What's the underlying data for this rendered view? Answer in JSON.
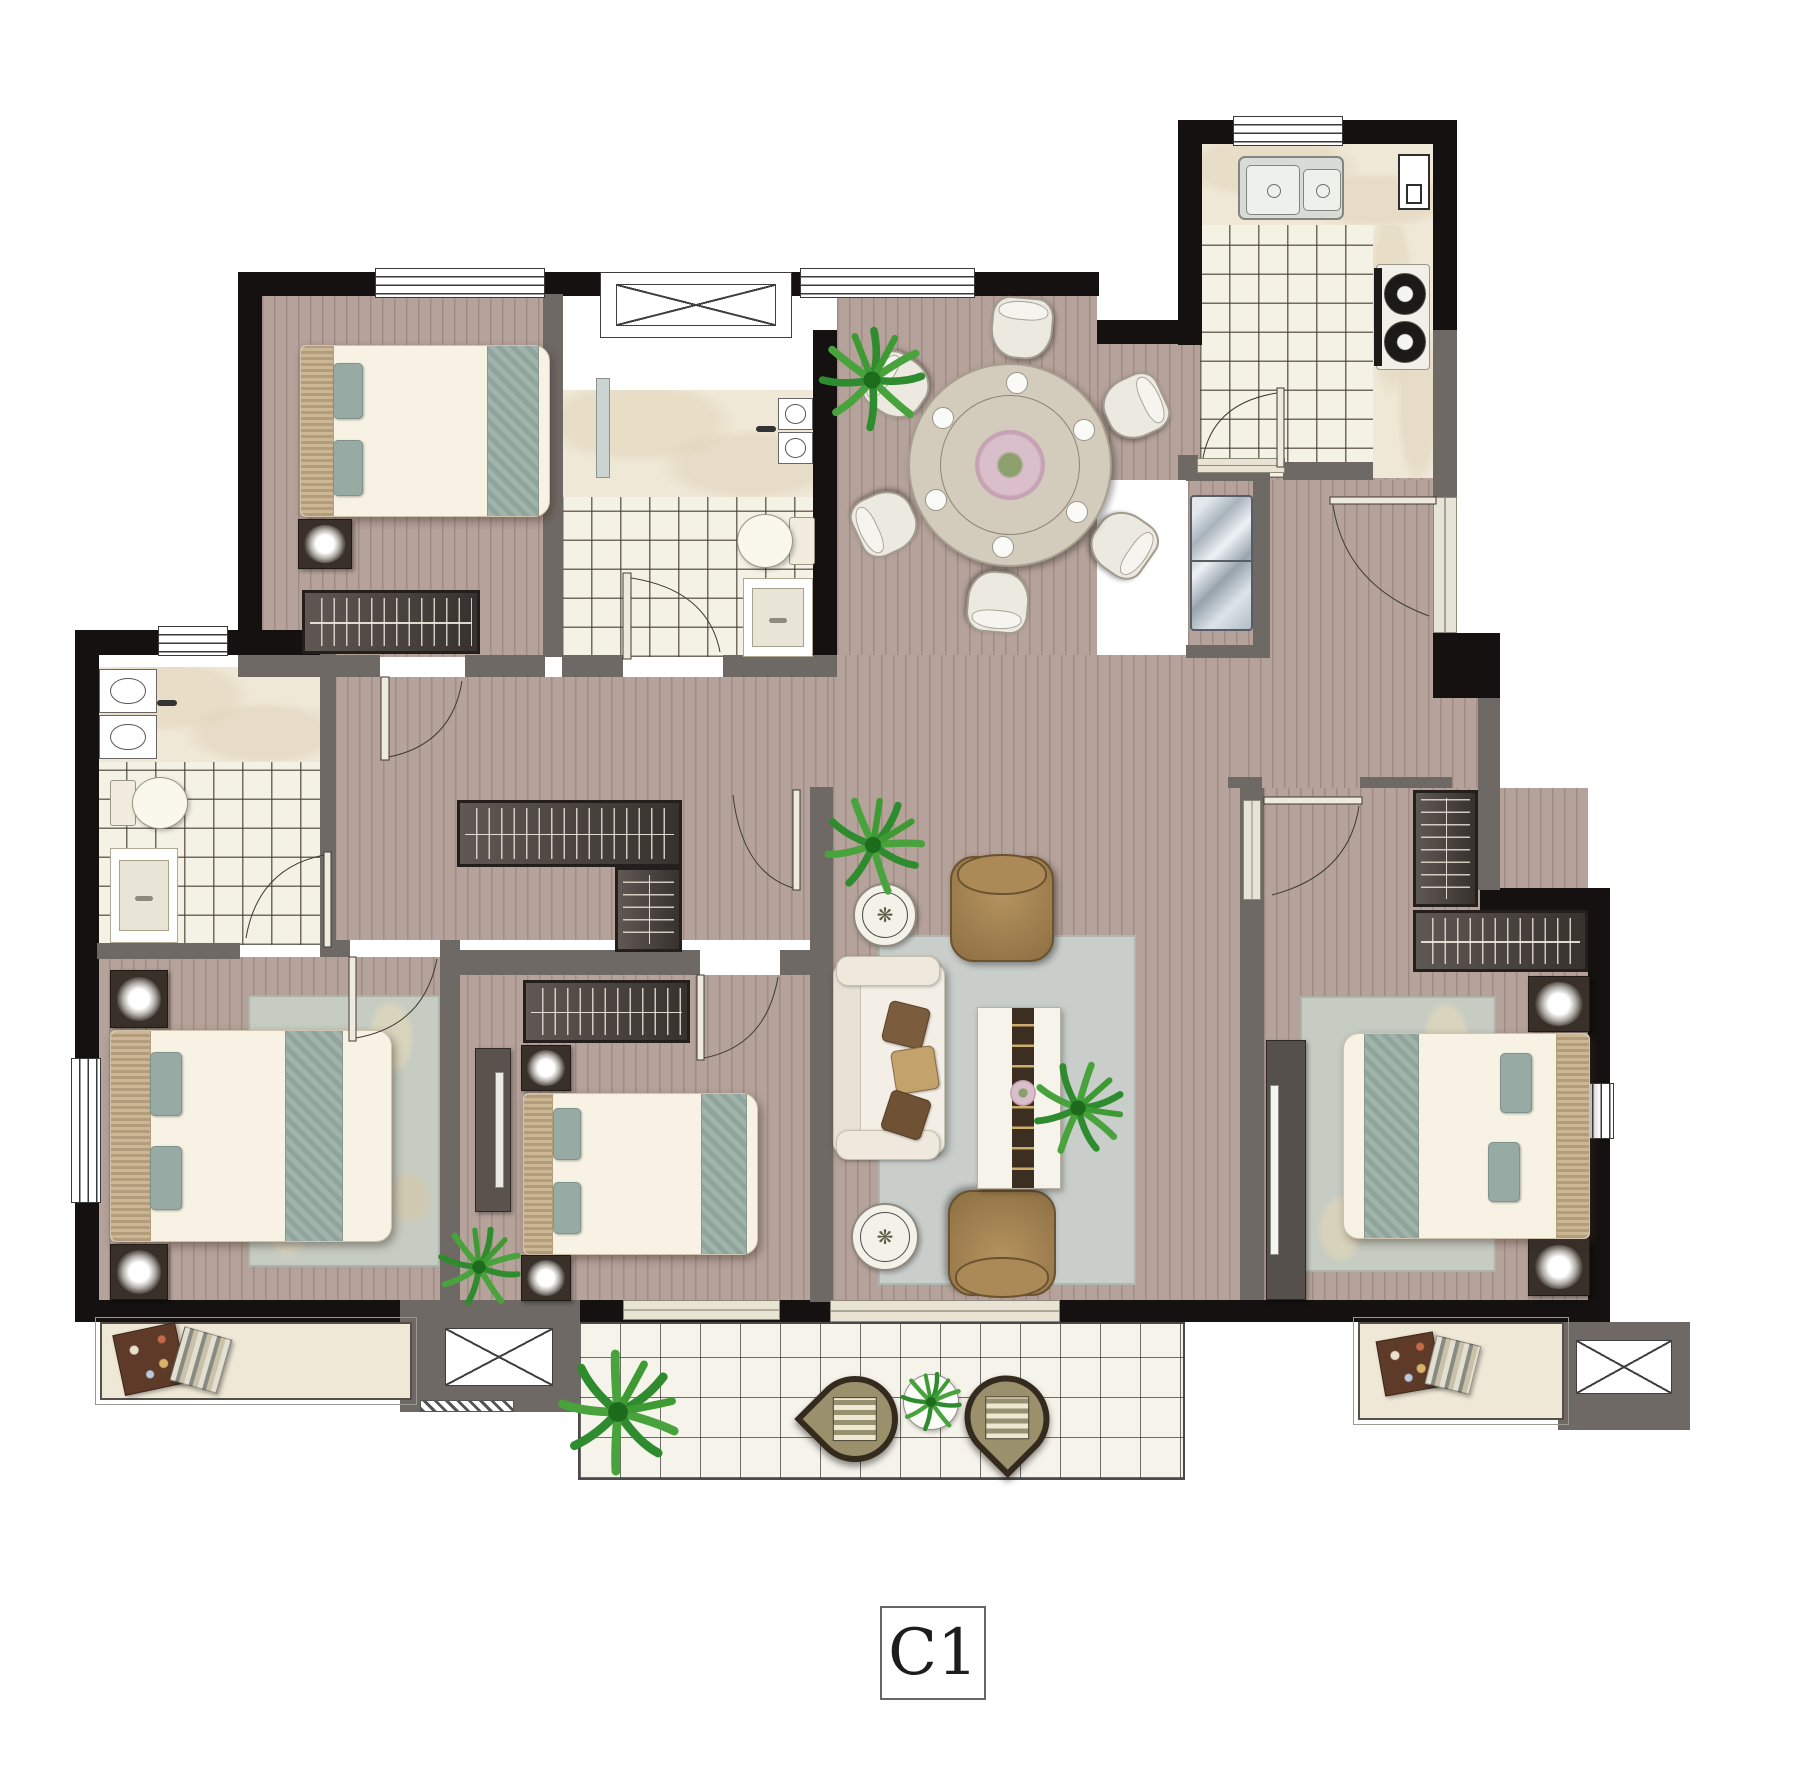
{
  "plan": {
    "unit_label": "C1",
    "type": "apartment-floor-plan"
  },
  "colors": {
    "background": "#ffffff",
    "wall_structural": "#141110",
    "wall_partition": "#6f6965",
    "wood_floor": "#b5a29a",
    "tile_floor": "#f4f1e5",
    "marble": "#efe8d7",
    "rug_gray": "#c9cecb",
    "bed_linen": "#f7f2e3",
    "accent_teal": "#97aaa3",
    "armchair_brown": "#a5834f",
    "wardrobe_wood": "#4d4540",
    "plant_green": "#2e8b2e",
    "balcony_chair_olive": "#9a906c"
  },
  "icons": {
    "shaft": "crossed-box-icon",
    "window": "triple-line-strip-icon",
    "door": "quarter-arc-swing-icon",
    "plant": "leaf-burst-icon",
    "lamp": "glow-flower-icon"
  },
  "rooms": [
    {
      "name": "bedroom-top-left"
    },
    {
      "name": "bathroom-ensuite-top"
    },
    {
      "name": "dining-area"
    },
    {
      "name": "kitchen"
    },
    {
      "name": "entry-hall"
    },
    {
      "name": "bathroom-left"
    },
    {
      "name": "master-bedroom"
    },
    {
      "name": "bedroom-center"
    },
    {
      "name": "living-room"
    },
    {
      "name": "bedroom-right"
    },
    {
      "name": "balcony"
    }
  ]
}
